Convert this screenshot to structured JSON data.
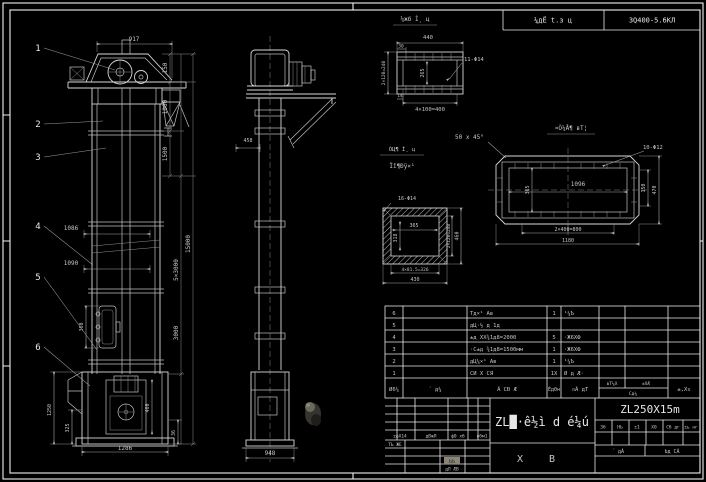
{
  "colors": {
    "background": "#000000",
    "line": "#d8d8d8",
    "dim_line": "#a8a8a8",
    "text": "#c6c6c6",
    "highlight_box": "#8a8578"
  },
  "header": {
    "process_cell": "¼дЁ t.з ц",
    "spec_cell": "3Q400-5.6KЛ"
  },
  "balloons": {
    "b1": "1",
    "b2": "2",
    "b3": "3",
    "b4": "4",
    "b5": "5",
    "b6": "6"
  },
  "front_dims": {
    "top_width": "917",
    "seg_150": "150",
    "seg_1000": "1000",
    "seg_1500": "1500",
    "seg_5x3000": "5×3000",
    "seg_3000": "3000",
    "total_height": "15000",
    "len_1086": "1086",
    "len_1090": "1090",
    "door_height": "360",
    "boot_height": "1250",
    "boot_325": "325",
    "boot_width": "1286",
    "boot_460": "460",
    "boot_36": "36"
  },
  "side_dims": {
    "width_948": "948",
    "dim_458": "458"
  },
  "detail_top": {
    "title": "¼жб Ì¸ ц",
    "dim_440": "440",
    "dim_30": "30",
    "dim_left": "2×120=240",
    "dim_265": "265",
    "dim_14": "14",
    "dim_bottom": "4×100=400",
    "holes": "11-Φ14"
  },
  "detail_right": {
    "title": "¤Ò¼Å¶ вТ¦",
    "chamfer": "50 x 45°",
    "holes": "10-Φ12",
    "dim_1096": "1096",
    "dim_365": "365",
    "dim_150": "150",
    "dim_470": "470",
    "dim_800": "2×400=800",
    "dim_1180": "1180"
  },
  "detail_square": {
    "title_line1": "ÓЦ¶ Ì¸ ц",
    "title_line2": "Ïî¶Ðÿ×¹",
    "holes": "16-Φ14",
    "dim_365": "365",
    "dim_318": "318",
    "dim_right_inner": "2×120=240",
    "dim_460": "460",
    "dim_bottom1": "4×81.5=326",
    "dim_bottom2": "430"
  },
  "bom": {
    "headers": {
      "no": "Ø6¼",
      "code": "´ д¼",
      "name": "Ã СÐ Æ",
      "qty": "Éд0н",
      "material": "¤Ã дТ",
      "weight_top1": "вТ¼Х",
      "weight_top2": "±ХÆ",
      "weight_bottom": "Сд¼",
      "remark": "±,Х¤"
    },
    "rows": [
      {
        "no": "6",
        "code": "",
        "name": "Тд×¹ Ав",
        "qty": "1",
        "material": "¹¼Ъ",
        "w1": "",
        "w2": "",
        "remark": ""
      },
      {
        "no": "5",
        "code": "",
        "name": "дЦ·½ д 1д",
        "qty": "",
        "material": "",
        "w1": "",
        "w2": "",
        "remark": ""
      },
      {
        "no": "4",
        "code": "",
        "name": "±д ХХ¾1д8=2000",
        "qty": "5",
        "material": "·Ж6ХФ",
        "w1": "",
        "w2": "",
        "remark": ""
      },
      {
        "no": "3",
        "code": "",
        "name": "·С±д ¾1д8=1500мм",
        "qty": "1",
        "material": "·Ж6ХФ",
        "w1": "",
        "w2": "",
        "remark": ""
      },
      {
        "no": "2",
        "code": "",
        "name": "дЦ¼×¹ Ав",
        "qty": "1",
        "material": "¹¼Ъ",
        "w1": "",
        "w2": "",
        "remark": ""
      },
      {
        "no": "1",
        "code": "",
        "name": "СИ Х СЯ",
        "qty": "1Х",
        "material": "Ø д Æ·",
        "w1": "",
        "w2": "",
        "remark": ""
      }
    ]
  },
  "title_block": {
    "product_title": "ZL█·ê½ì d é¼ú",
    "drawing_no": "ZL250X15m",
    "sheet_char1": "Х",
    "sheet_char2": "В",
    "rev_labels": {
      "l1": "±фХ14",
      "l2": "дВжЛ",
      "l3": "ф0 хб",
      "l4": "вбм1",
      "sign1": "ТЬ ЖЕ",
      "sel": "ЬЬ",
      "sign2": "дЛ ÆВ"
    },
    "mini_headers": {
      "h1": "3б",
      "h2": "НЬ",
      "h3": "±1",
      "h4": "Х0",
      "h5": "Сб дг",
      "h6": "±ь нг"
    },
    "sheet_total": "´ дÁ",
    "sheet_no": "Ьд СÁ"
  }
}
